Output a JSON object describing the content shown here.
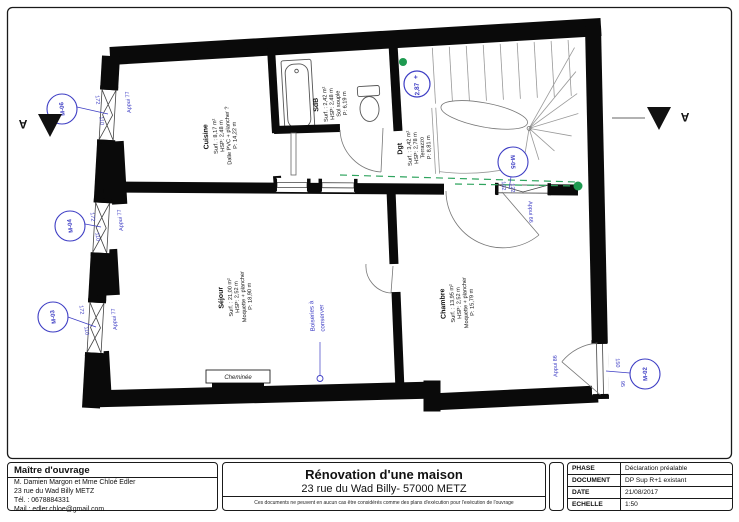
{
  "colors": {
    "annotation_blue": "#3d3dc4",
    "annotation_green": "#1e9a50",
    "wall_black": "#0a0a0a"
  },
  "plan": {
    "rooms": {
      "cuisine": {
        "name": "Cuisine",
        "surface": "Surf. : 8,17 m²",
        "hsp": "HSP: 2,48 m",
        "floor": "Dalle PVC + plancher ?",
        "perimeter": "P: 14,22 m"
      },
      "sdb": {
        "name": "SdB",
        "surface": "Surf. : 2,42 m²",
        "hsp": "HSP: 2,48 m",
        "floor": "Sol souple",
        "perimeter": "P: 6,19 m"
      },
      "dgt": {
        "name": "Dgt",
        "surface": "Surf. : 3,42 m²",
        "hsp": "HSP: 2,78 m",
        "floor": "Terrazzo",
        "perimeter": "P: 8,81 m"
      },
      "sejour": {
        "name": "Séjour",
        "surface": "Surf. : 21,00 m²",
        "hsp": "HSP: 2,52 m",
        "floor": "Moquette + plancher",
        "perimeter": "P: 18,90 m"
      },
      "chambre": {
        "name": "Chambre",
        "surface": "Surf. : 13,95 m²",
        "hsp": "HSP: 2,52 m",
        "floor": "Moquette + plancher",
        "perimeter": "P: 15,79 m"
      }
    },
    "windows": {
      "m06": {
        "id": "M-06",
        "w": "110",
        "h": "172",
        "appui": "Appui 77"
      },
      "m04": {
        "id": "M-04",
        "w": "110",
        "h": "172",
        "appui": "Appui 77"
      },
      "m03": {
        "id": "M-03",
        "w": "110",
        "h": "172",
        "appui": "Appui 77"
      },
      "m05": {
        "id": "M-05",
        "w": "102",
        "h": "122",
        "appui": "Appui 66"
      },
      "m02": {
        "id": "M-02",
        "w": "95",
        "h": "150",
        "appui": "Appui 86"
      }
    },
    "level_marker": {
      "plus": "+",
      "value": "2,87"
    },
    "section_label": "A",
    "notes": {
      "boiseries_line1": "Boiseries à",
      "boiseries_line2": "conserver",
      "cheminee": "Cheminée"
    }
  },
  "titleblock": {
    "owner": {
      "title": "Maître d'ouvrage",
      "line1": "M. Damien Margon et Mme Chloé Edler",
      "line2": "23 rue du Wad Billy METZ",
      "line3": "Tél. : 0678884331",
      "line4": "Mail : edler.chloe@gmail.com"
    },
    "project": {
      "title": "Rénovation d'une maison",
      "subtitle": "23 rue du Wad Billy- 57000 METZ",
      "disclaimer": "Ces documents ne peuvent en aucun cas être considérés comme des plans d'exécution pour l'exécution de l'ouvrage"
    },
    "meta": {
      "rows": [
        {
          "label": "PHASE",
          "value": "Déclaration préalable"
        },
        {
          "label": "DOCUMENT",
          "value": "DP Sup R+1 existant"
        },
        {
          "label": "DATE",
          "value": "21/08/2017"
        },
        {
          "label": "ECHELLE",
          "value": "1:50"
        }
      ]
    }
  }
}
